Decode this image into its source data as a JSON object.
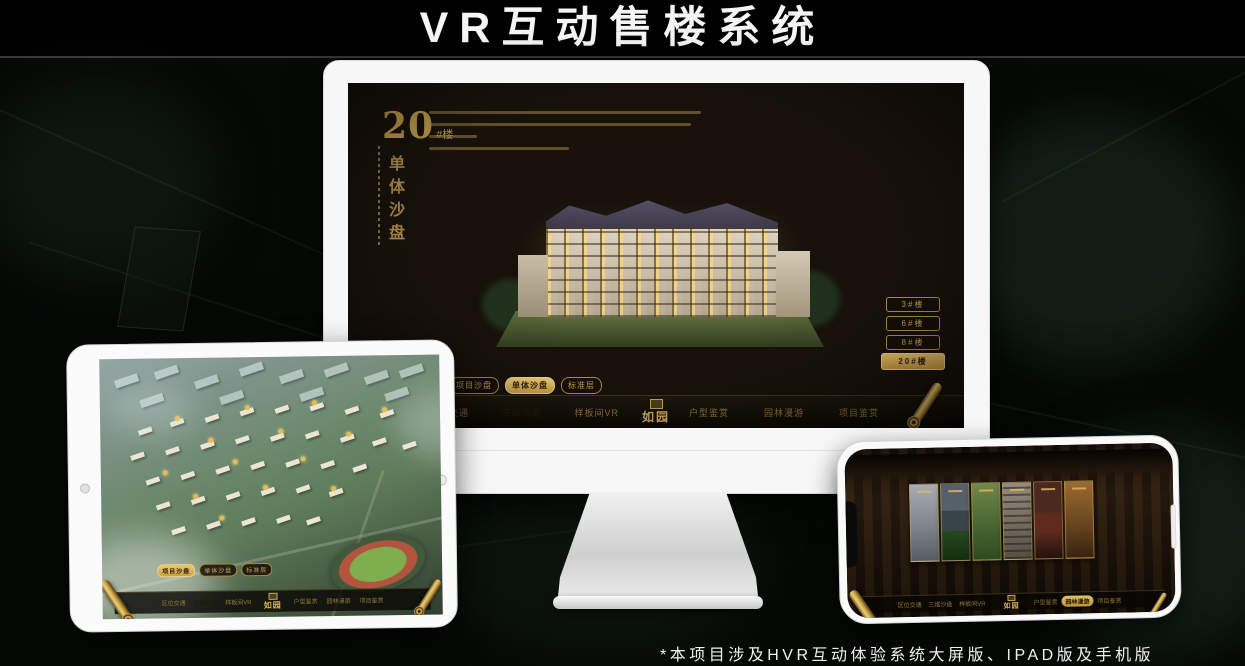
{
  "title": "VR互动售楼系统",
  "footnote": "*本项目涉及HVR互动体验系统大屏版、IPAD版及手机版",
  "colors": {
    "accent_gold": "#d2a84e",
    "active_tab_background": "#ddb45f",
    "screen_background": "#17110a",
    "title_text": "#f5f5f5"
  },
  "monitor": {
    "unit_number": "20",
    "unit_suffix": "#楼",
    "unit_caption": "单体沙盘",
    "floor_buttons": [
      {
        "label": "3#楼",
        "active": false
      },
      {
        "label": "6#楼",
        "active": false
      },
      {
        "label": "8#楼",
        "active": false
      },
      {
        "label": "20#楼",
        "active": true
      }
    ],
    "sub_tabs": [
      {
        "label": "项目沙盘",
        "active": false
      },
      {
        "label": "单体沙盘",
        "active": true
      },
      {
        "label": "标准层",
        "active": false
      }
    ],
    "nav_left": [
      {
        "label": "区位交通",
        "active": false
      },
      {
        "label": "三维沙盘",
        "active": true
      },
      {
        "label": "样板间VR",
        "active": false
      }
    ],
    "logo": "如园",
    "nav_right": [
      {
        "label": "户型鉴赏",
        "active": false
      },
      {
        "label": "园林漫游",
        "active": false
      },
      {
        "label": "项目鉴赏",
        "active": false
      }
    ]
  },
  "tablet": {
    "sub_tabs": [
      {
        "label": "项目沙盘",
        "active": true
      },
      {
        "label": "单体沙盘",
        "active": false
      },
      {
        "label": "标准层",
        "active": false
      }
    ],
    "nav_left": [
      {
        "label": "区位交通",
        "active": false
      },
      {
        "label": "三维沙盘",
        "active": true
      },
      {
        "label": "样板间VR",
        "active": false
      }
    ],
    "logo": "如园",
    "nav_right": [
      {
        "label": "户型鉴赏",
        "active": false
      },
      {
        "label": "园林漫游",
        "active": false
      },
      {
        "label": "项目鉴赏",
        "active": false
      }
    ]
  },
  "phone": {
    "nav_left": [
      {
        "label": "区位交通",
        "active": false
      },
      {
        "label": "三维沙盘",
        "active": false
      },
      {
        "label": "样板间VR",
        "active": false
      }
    ],
    "logo": "如园",
    "nav_right": [
      {
        "label": "户型鉴赏",
        "active": false
      },
      {
        "label": "园林漫游",
        "active": true
      },
      {
        "label": "项目鉴赏",
        "active": false
      }
    ]
  }
}
